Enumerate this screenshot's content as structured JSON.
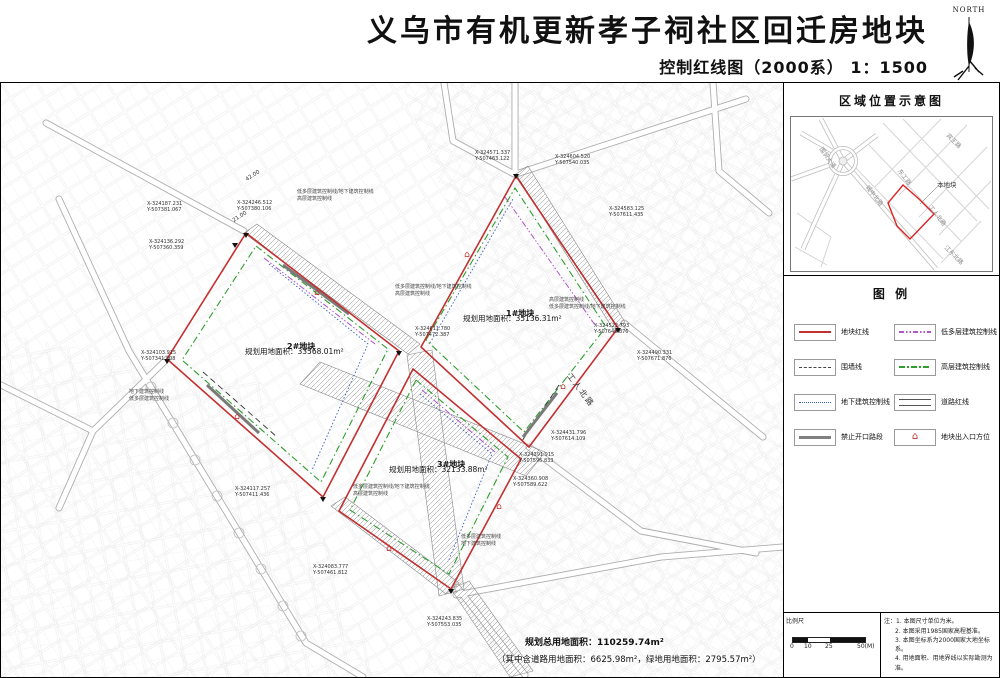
{
  "header": {
    "title": "义乌市有机更新孝子祠社区回迁房地块",
    "subtitle": "控制红线图（2000系） 1：1500",
    "north_label": "NORTH"
  },
  "location_panel": {
    "title": "区域位置示意图",
    "plot_label": "本地块",
    "roads": [
      "国贸大道",
      "宾王路",
      "东工路",
      "城中北路",
      "工人北路",
      "江东北路"
    ]
  },
  "legend": {
    "title": "图  例",
    "items": [
      {
        "label": "地块红线",
        "style": "red-solid"
      },
      {
        "label": "低多层建筑控制线",
        "style": "purple-dash-dot-dot"
      },
      {
        "label": "围墙线",
        "style": "black-dashed"
      },
      {
        "label": "高层建筑控制线",
        "style": "green-dash-dot"
      },
      {
        "label": "地下建筑控制线",
        "style": "blue-dotted"
      },
      {
        "label": "道路红线",
        "style": "double-line"
      },
      {
        "label": "禁止开口路段",
        "style": "gray-thick"
      },
      {
        "label": "地块出入口方位",
        "style": "entrance-symbol"
      }
    ],
    "entrance_glyph": "⌂"
  },
  "map": {
    "plots": [
      {
        "name": "1#地块",
        "area_label": "规划用地面积：35136.31m²"
      },
      {
        "name": "2#地块",
        "area_label": "规划用地面积：33568.01m²"
      },
      {
        "name": "3#地块",
        "area_label": "规划用地面积：32133.88m²"
      }
    ],
    "roads": [
      "工人北路"
    ],
    "dims": [
      "42.00",
      "21.00"
    ],
    "annotations": [
      "低多层建筑控制线/地下建筑控制线",
      "高层建筑控制线",
      "低多层建筑控制线",
      "地下建筑控制线"
    ],
    "summary_line1": "规划总用地面积：110259.74m²",
    "summary_line2": "（其中含道路用地面积：6625.98m²，绿地用地面积：2795.57m²）",
    "coord_labels": [
      {
        "l1": "X-324187.231",
        "l2": "Y-507381.067"
      },
      {
        "l1": "X-324136.292",
        "l2": "Y-507360.359"
      },
      {
        "l1": "X-324246.512",
        "l2": "Y-507380.106"
      },
      {
        "l1": "X-324611.780",
        "l2": "Y-507472.387"
      },
      {
        "l1": "X-324571.337",
        "l2": "Y-507463.122"
      },
      {
        "l1": "X-324604.520",
        "l2": "Y-507540.035"
      },
      {
        "l1": "X-324583.125",
        "l2": "Y-507611.435"
      },
      {
        "l1": "X-324522.793",
        "l2": "Y-507646.876"
      },
      {
        "l1": "X-324490.331",
        "l2": "Y-507671.876"
      },
      {
        "l1": "X-324431.796",
        "l2": "Y-507614.109"
      },
      {
        "l1": "X-324391.915",
        "l2": "Y-507596.833"
      },
      {
        "l1": "X-324360.908",
        "l2": "Y-507589.622"
      },
      {
        "l1": "X-324243.835",
        "l2": "Y-507553.035"
      },
      {
        "l1": "X-324103.915",
        "l2": "Y-507341.808"
      },
      {
        "l1": "X-324117.257",
        "l2": "Y-507411.436"
      },
      {
        "l1": "X-324083.777",
        "l2": "Y-507461.812"
      }
    ]
  },
  "scale": {
    "label": "比例尺",
    "ticks": [
      "0",
      "10",
      "25",
      "50(M)"
    ]
  },
  "notes": {
    "prefix": "注：",
    "lines": [
      "1. 本图尺寸单位为米。",
      "2. 本图采用1985国家高程基准。",
      "3. 本图坐标系为2000国家大地坐标系。",
      "4. 用地面积、用地界线以实际勘测为准。"
    ]
  },
  "colors": {
    "plot_redline": "#c23030",
    "highrise_control": "#2f9e2f",
    "lowrise_control": "#b255c8",
    "underground_control": "#3b5fc0",
    "no_opening": "#808080"
  }
}
